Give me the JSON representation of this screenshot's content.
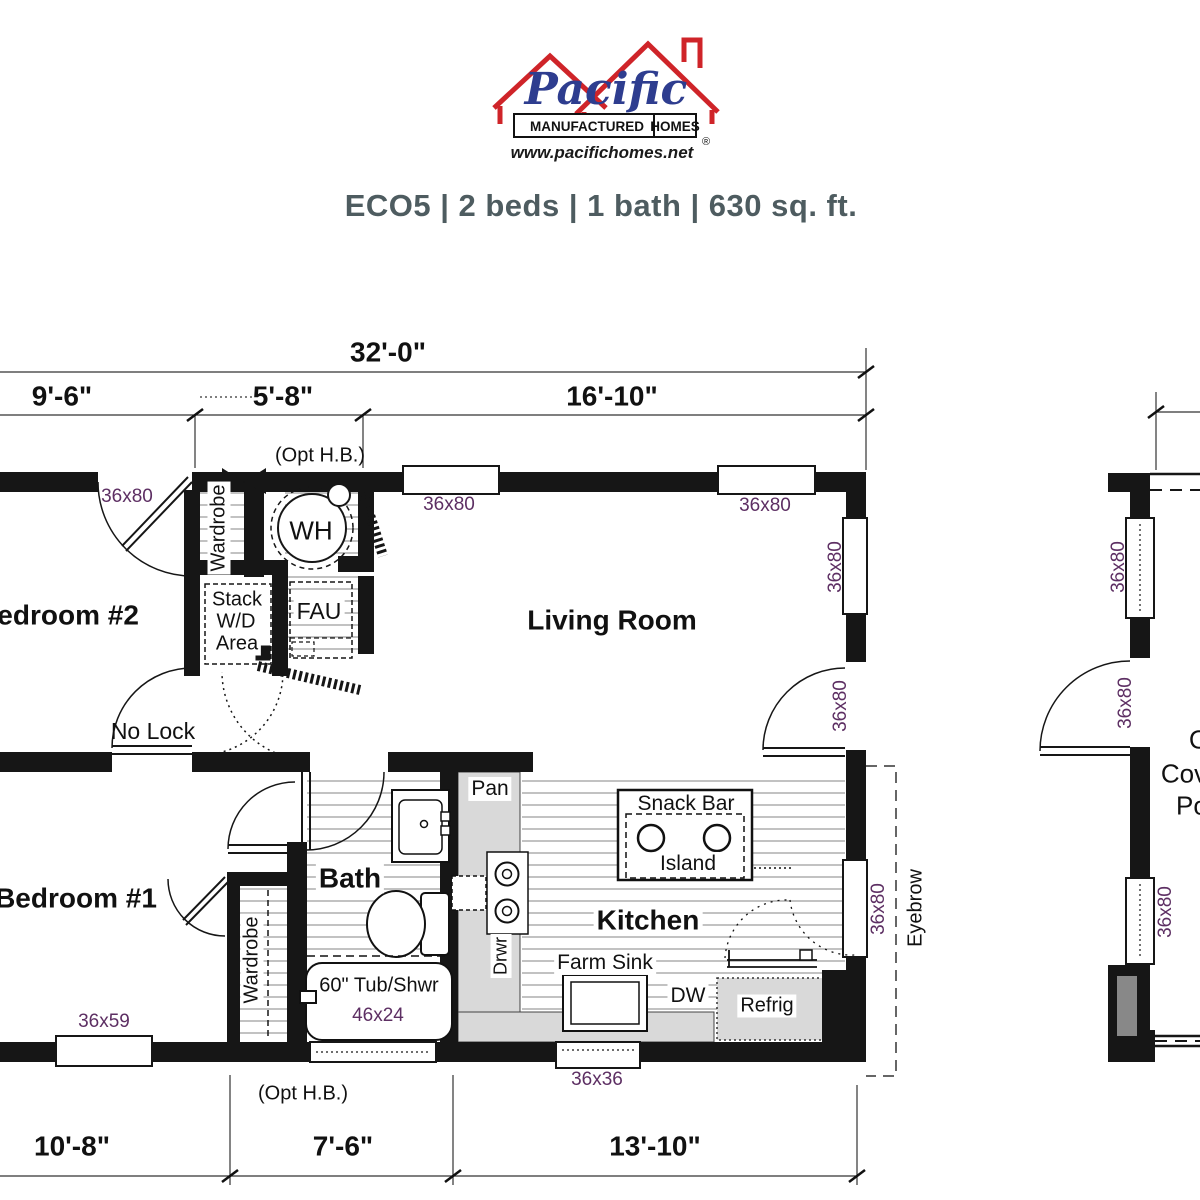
{
  "logo": {
    "brand": "Pacific",
    "tagline_left": "MANUFACTURED",
    "tagline_right": "HOMES",
    "registered": "®",
    "website": "www.pacifichomes.net"
  },
  "header": {
    "title": "ECO5 | 2 beds | 1 bath | 630 sq. ft."
  },
  "dimensions": {
    "overall": "32'-0\"",
    "top_left": "9'-6\"",
    "top_mid": "5'-8\"",
    "top_right": "16'-10\"",
    "bottom_left": "10'-8\"",
    "bottom_mid": "7'-6\"",
    "bottom_right": "13'-10\"",
    "opt_hose_bib": "(Opt H.B.)"
  },
  "rooms": {
    "bedroom2": "Bedroom #2",
    "living_room": "Living Room",
    "bedroom1": "Bedroom #1",
    "bath": "Bath",
    "kitchen": "Kitchen"
  },
  "labels": {
    "wardrobe": "Wardrobe",
    "water_heater": "WH",
    "fau": "FAU",
    "stack_wd_line1": "Stack",
    "stack_wd_line2": "W/D",
    "stack_wd_line3": "Area",
    "no_lock": "No Lock",
    "pantry": "Pan",
    "snack_bar": "Snack Bar",
    "island": "Island",
    "drawer": "Drwr",
    "farm_sink": "Farm Sink",
    "dishwasher": "DW",
    "refrigerator": "Refrig",
    "tub": "60\" Tub/Shwr",
    "eyebrow": "Eyebrow"
  },
  "sizes": {
    "door_window_36x80": "36x80",
    "bedroom1_window": "36x59",
    "tub_size": "46x24",
    "kitchen_window": "36x36"
  },
  "side_unit": {
    "line1": "Opt",
    "line2": "Covered",
    "line3": "Porch"
  },
  "colors": {
    "wall_black": "#161616",
    "size_label_purple": "#5d2f63",
    "logo_red": "#cf2429",
    "logo_blue": "#2e3d8f",
    "title_gray": "#4e5c60",
    "counter_gray": "#d9d9d9"
  }
}
